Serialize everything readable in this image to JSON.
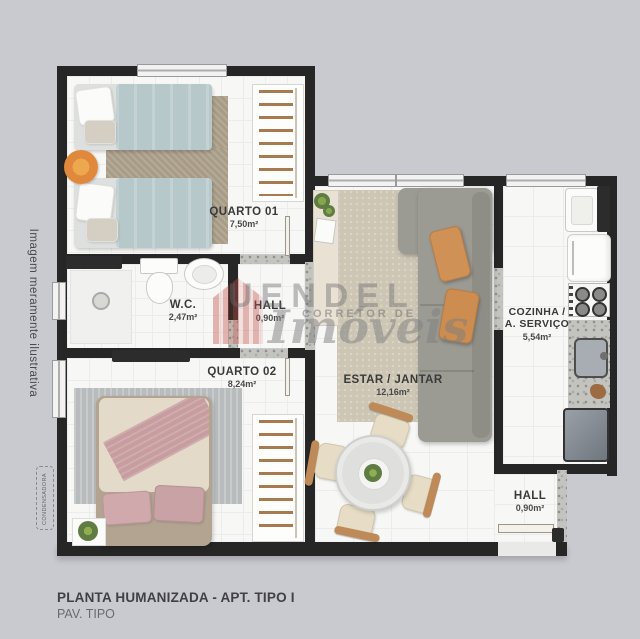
{
  "meta": {
    "side_note": "Imagem meramente ilustrativa",
    "condenser_label": "CONDENSADORA"
  },
  "watermark": {
    "name": "UENDEL",
    "subtitle": "CORRETOR DE",
    "script": "Imóveis"
  },
  "rooms": {
    "quarto1": {
      "label": "QUARTO 01",
      "area": "7,50m²"
    },
    "wc": {
      "label": "W.C.",
      "area": "2,47m²"
    },
    "hall1": {
      "label": "HALL",
      "area": "0,90m²"
    },
    "quarto2": {
      "label": "QUARTO 02",
      "area": "8,24m²"
    },
    "estar": {
      "label": "ESTAR / JANTAR",
      "area": "12,16m²"
    },
    "cozinha": {
      "label1": "COZINHA /",
      "label2": "A. SERVIÇO",
      "area": "5,54m²"
    },
    "hall2": {
      "label": "HALL",
      "area": "0,90m²"
    }
  },
  "footer": {
    "title": "PLANTA HUMANIZADA - APT. TIPO I",
    "subtitle": "PAV. TIPO"
  },
  "colors": {
    "background": "#c9c9d0",
    "wall": "#262626",
    "bed_blue": "#b7c8cb",
    "bed_pink": "#c59a9d",
    "sofa_gray": "#9b9b93",
    "cushion_orange": "#d09156",
    "rug_brown": "#a89c87",
    "rug_beige": "#cdc6b5",
    "accent_orange": "#e0893c",
    "watermark_red": "#c2554f"
  }
}
